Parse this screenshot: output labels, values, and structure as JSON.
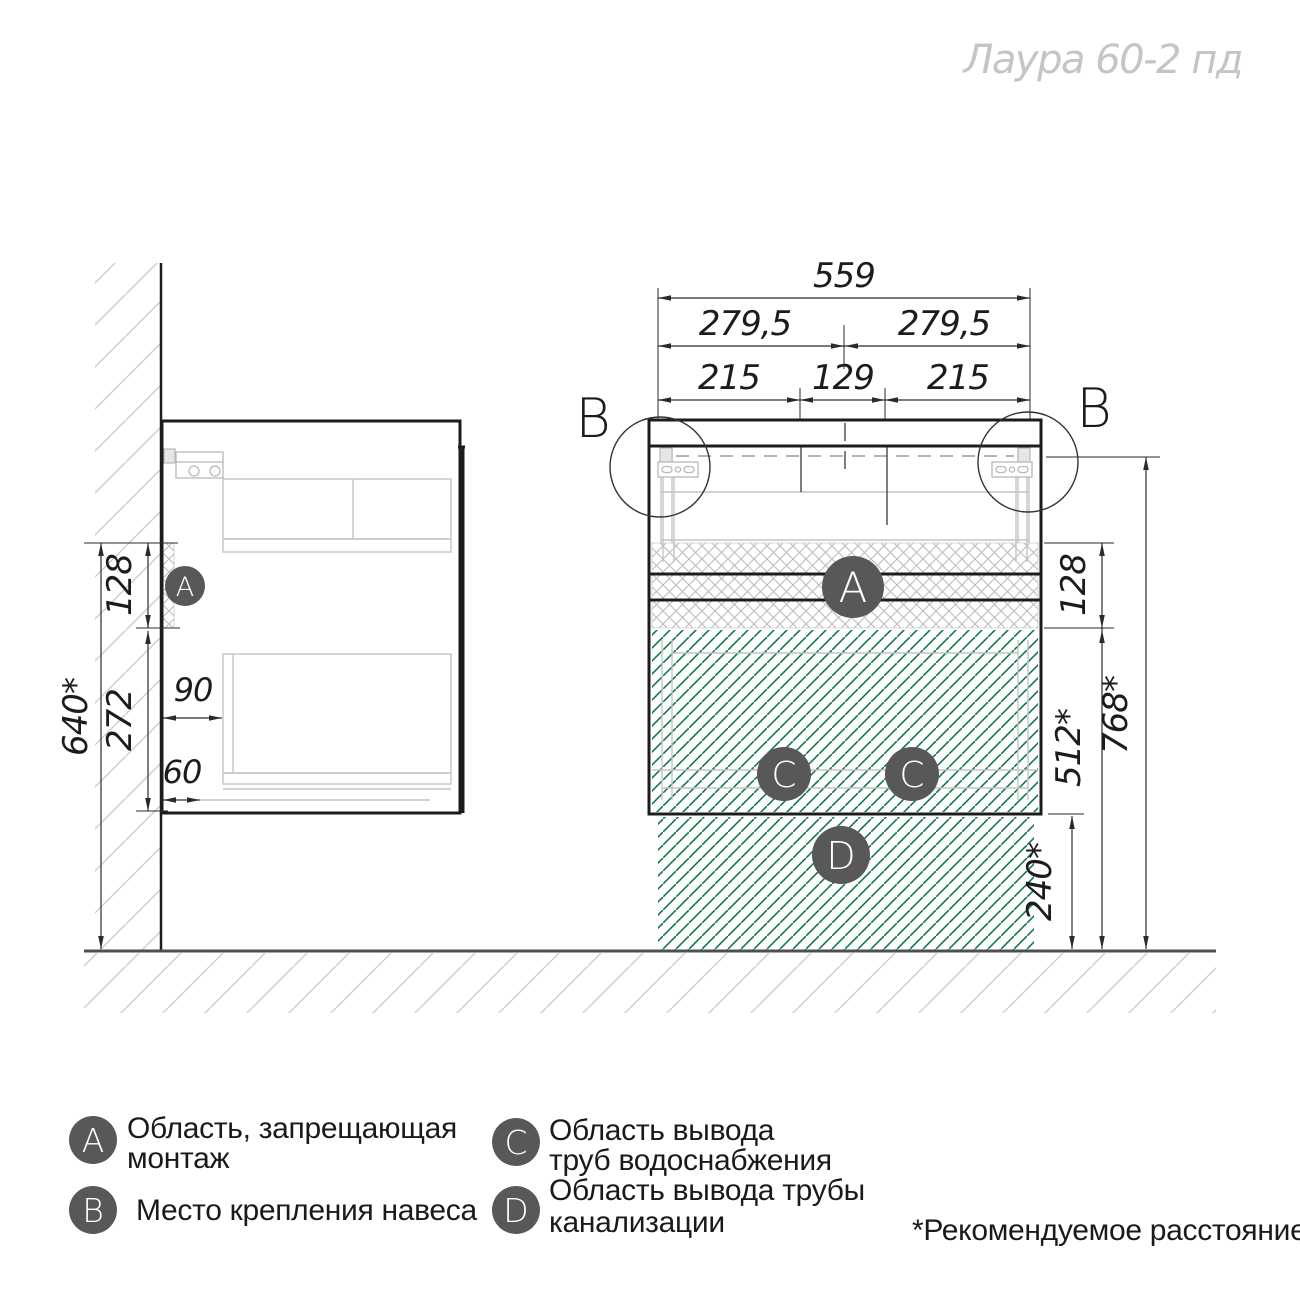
{
  "title": "Лаура 60-2 пд",
  "dims": {
    "total_width": "559",
    "half_left": "279,5",
    "half_right": "279,5",
    "span_left": "215",
    "span_center": "129",
    "span_right": "215",
    "band_right": "128",
    "below_band_right": "512*",
    "mount_height": "768*",
    "drain_height": "240*",
    "band_left": "128",
    "wall_clear": "640*",
    "below_band_left": "272",
    "back_gap": "90",
    "bottom_gap": "60"
  },
  "markers": {
    "a": "A",
    "b": "B",
    "c": "C",
    "d": "D"
  },
  "legend": {
    "items": [
      {
        "letter": "A",
        "lines": [
          "Область, запрещающая",
          "монтаж"
        ]
      },
      {
        "letter": "B",
        "lines": [
          "Место крепления навеса"
        ]
      },
      {
        "letter": "C",
        "lines": [
          "Область вывода",
          "труб водоснабжения"
        ]
      },
      {
        "letter": "D",
        "lines": [
          "Область вывода трубы",
          "канализации"
        ]
      }
    ],
    "footnote": "*Рекомендуемое расстояние"
  },
  "colors": {
    "pipe_area_green": "#0f7a48",
    "hatch_gray": "#bcbcbc",
    "badge_gray": "#58585a",
    "title_gray": "#c5c5c5",
    "line_black": "#1c1c1c"
  }
}
